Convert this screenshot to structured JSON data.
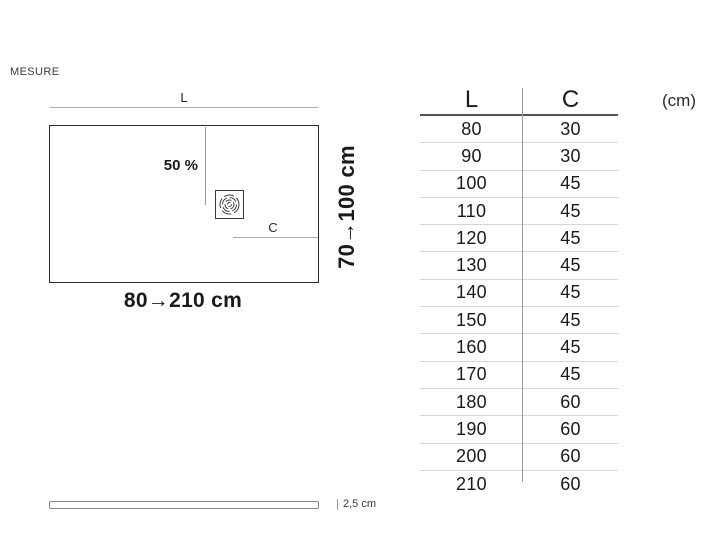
{
  "header": {
    "label": "MESURE"
  },
  "diagram": {
    "top_dim_label": "L",
    "slope_label": "50 %",
    "drain_dim_label": "C",
    "length_range": "80→210 cm",
    "depth_range": "70→100 cm",
    "thickness": "2,5 cm",
    "drain_icon": "drain-swirl-icon"
  },
  "table": {
    "columns": {
      "l": "L",
      "c": "C"
    },
    "unit": "(cm)",
    "rows": [
      {
        "l": "80",
        "c": "30"
      },
      {
        "l": "90",
        "c": "30"
      },
      {
        "l": "100",
        "c": "45"
      },
      {
        "l": "110",
        "c": "45"
      },
      {
        "l": "120",
        "c": "45"
      },
      {
        "l": "130",
        "c": "45"
      },
      {
        "l": "140",
        "c": "45"
      },
      {
        "l": "150",
        "c": "45"
      },
      {
        "l": "160",
        "c": "45"
      },
      {
        "l": "170",
        "c": "45"
      },
      {
        "l": "180",
        "c": "60"
      },
      {
        "l": "190",
        "c": "60"
      },
      {
        "l": "200",
        "c": "60"
      },
      {
        "l": "210",
        "c": "60"
      }
    ]
  },
  "colors": {
    "text": "#1a1a1a",
    "dim_line": "#aaaaaa",
    "outline": "#2b2b2b",
    "header_rule": "#555555",
    "row_rule": "#d6d6d6",
    "divider": "#9a9a9a"
  }
}
